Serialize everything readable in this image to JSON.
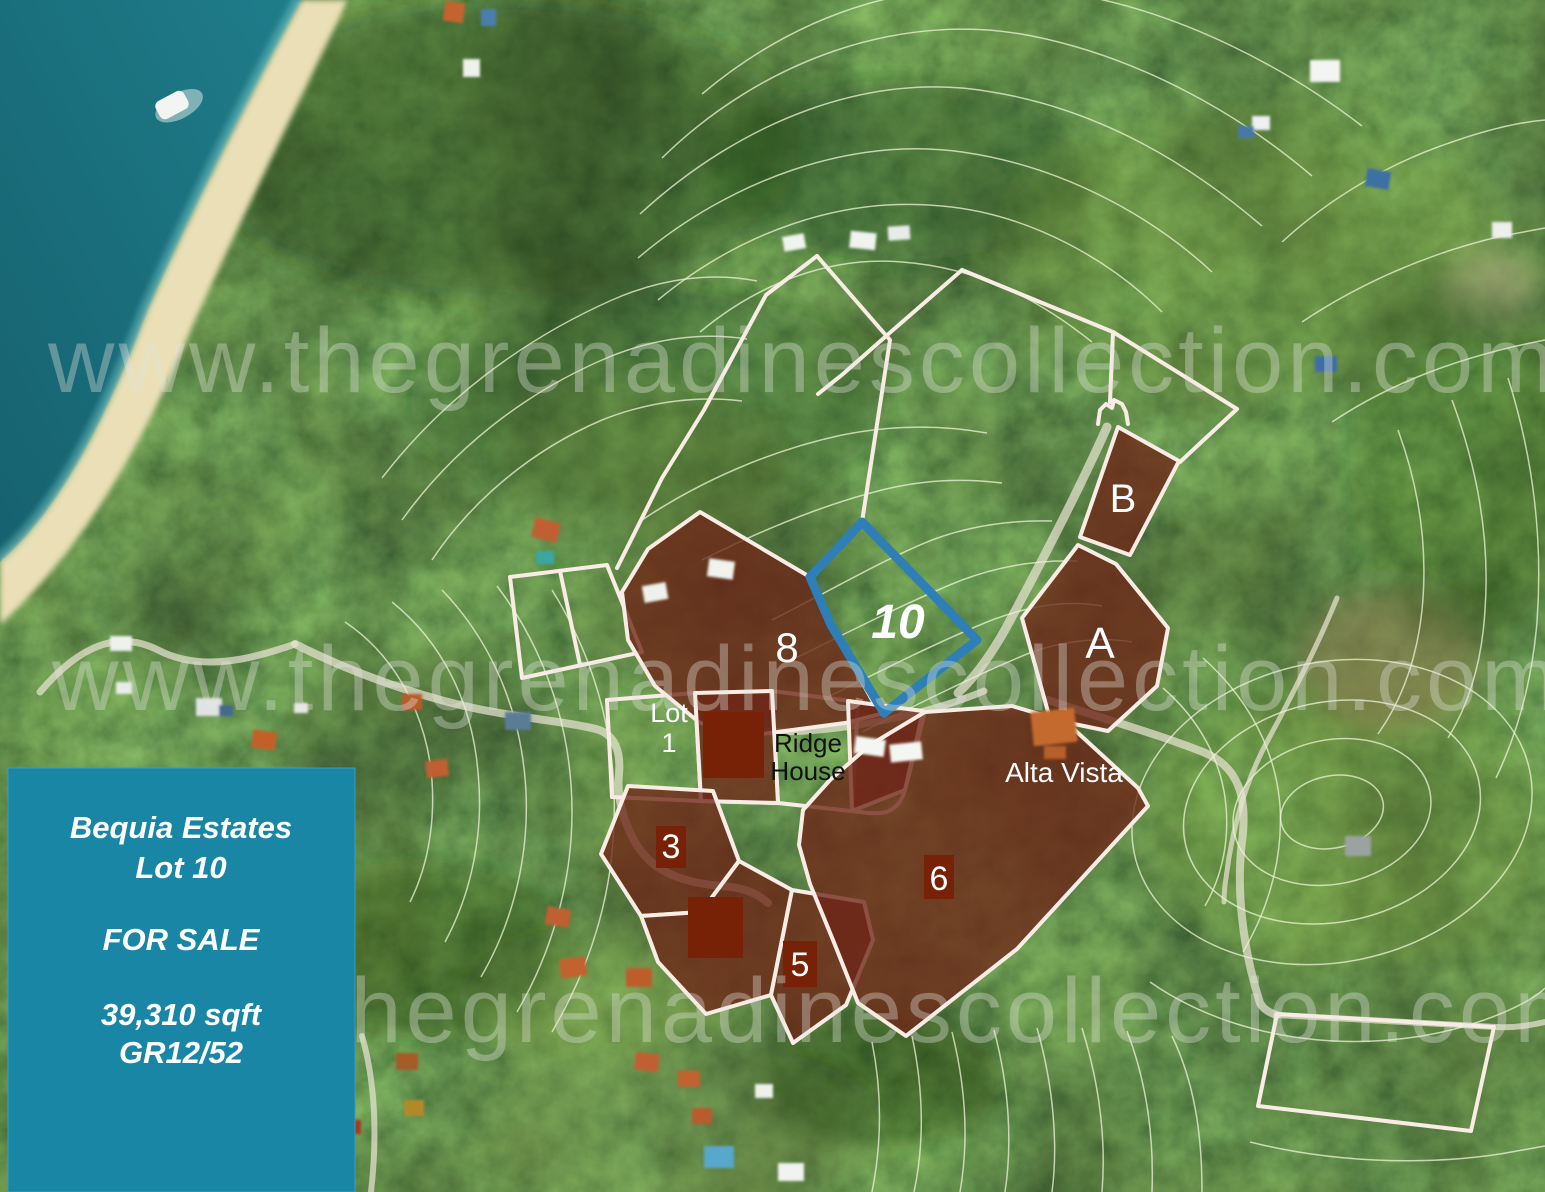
{
  "map": {
    "watermark_text": "www.thegrenadinescollection.com"
  },
  "info_box": {
    "line1": "Bequia Estates",
    "line2": "Lot 10",
    "line3": "FOR SALE",
    "line4": "39,310 sqft",
    "line5": "GR12/52"
  },
  "lot_labels": {
    "lot8": "8",
    "lot10": "10",
    "lotB": "B",
    "lotA": "A",
    "lot3": "3",
    "lot6": "6",
    "lot5": "5",
    "lot1_line1": "Lot",
    "lot1_line2": "1"
  },
  "place_labels": {
    "ridge_house_line1": "Ridge",
    "ridge_house_line2": "House",
    "alta_vista": "Alta Vista"
  },
  "colors": {
    "info_box_bg": "#1a86a5",
    "info_box_text": "#ffffff",
    "lot_fill": "#6e2517",
    "lot_square": "#772106",
    "boundary_line": "#f9ece5",
    "contour_line": "#ecf4d5",
    "highlight_border": "#2e7fb7",
    "ocean": "#1f7d8a",
    "ocean_deep": "#16616f",
    "beach": "#eadfb6",
    "watermark": "#e4e6de",
    "label_text": "#ffffff",
    "ridge_house_text": "#111111"
  }
}
